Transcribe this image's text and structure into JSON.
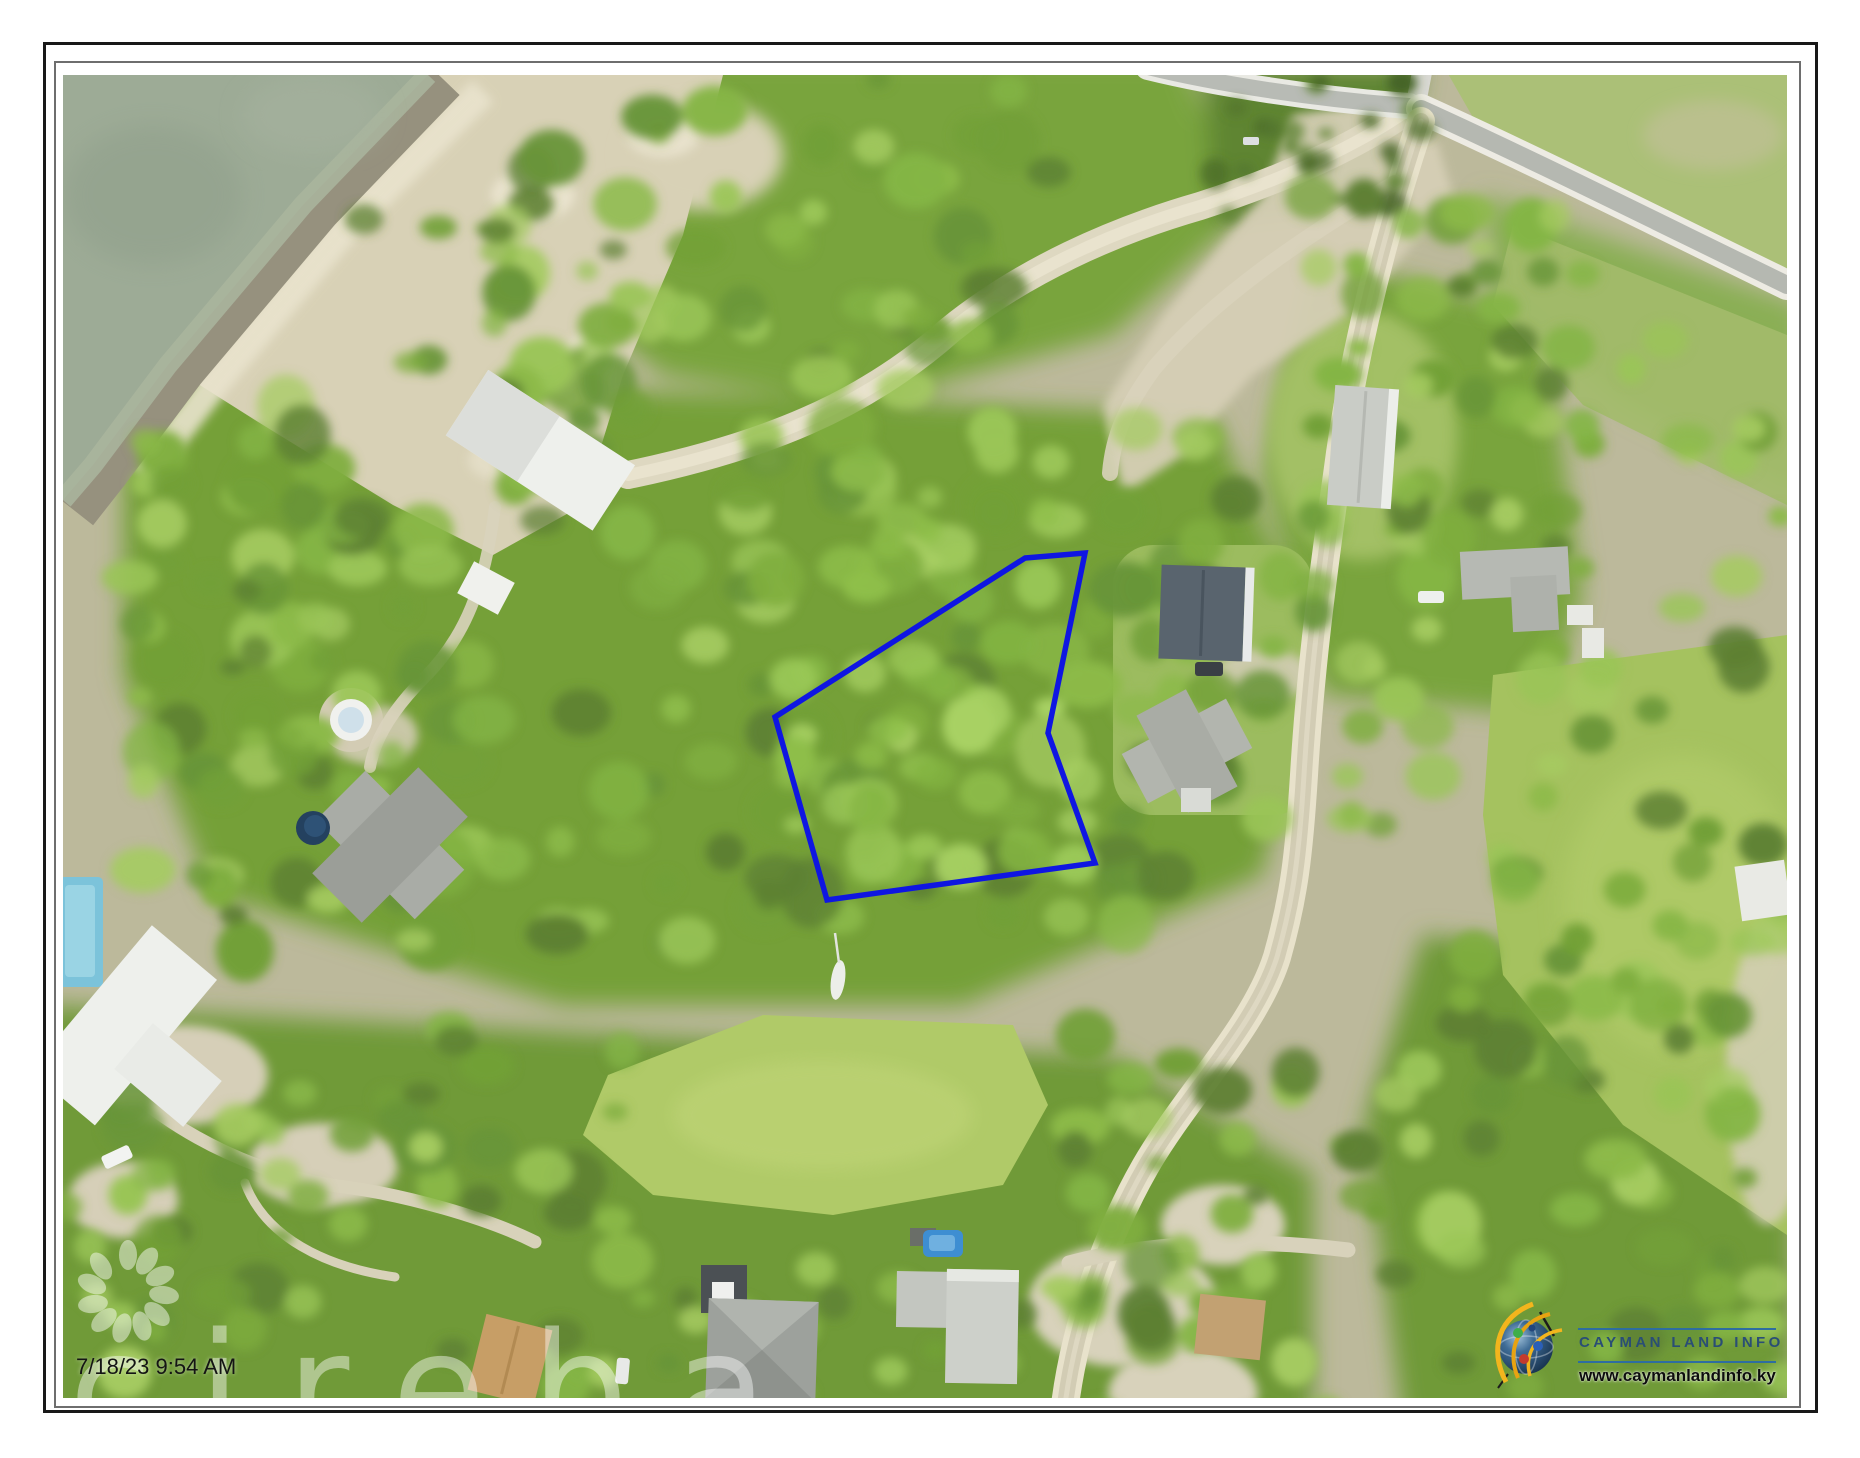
{
  "map": {
    "timestamp": "7/18/23 9:54 AM",
    "watermark": "cireba",
    "parcel": {
      "points": "962,483 1022,478 985,658 1032,788 764,825 712,642",
      "color": "#0f16e2"
    }
  },
  "branding": {
    "name": "CAYMAN LAND INFO",
    "website": "www.caymanlandinfo.ky",
    "icon": "globe-network-icon",
    "name_color": "#2a4e75",
    "rule_color": "#2e6da0"
  },
  "palette": {
    "water": "#9dab96",
    "shore_rock": "#96917e",
    "sand": "#d8d1b6",
    "vegetation": "#7fae3f",
    "grass_field": "#b0ca68",
    "road": "#d2ccb4",
    "parcel_outline": "#0f16e2"
  }
}
